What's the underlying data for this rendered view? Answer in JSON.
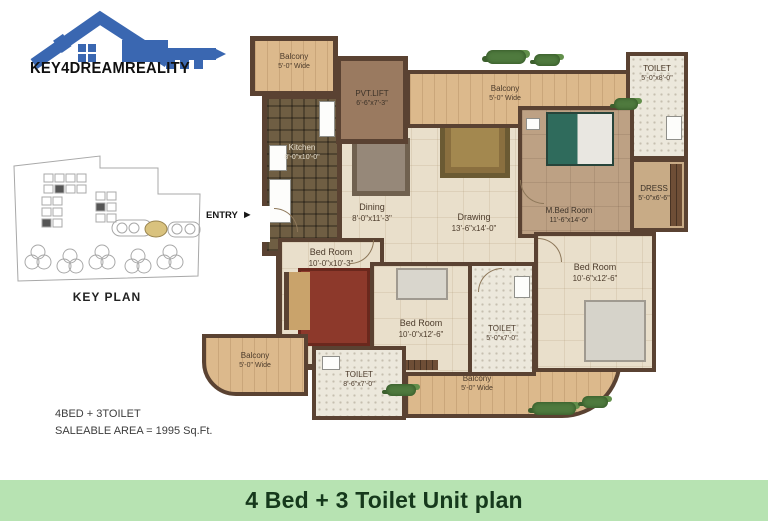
{
  "brand": {
    "name": "KEY4DREAMREALITY"
  },
  "key_plan": {
    "label": "KEY PLAN"
  },
  "entry": {
    "label": "ENTRY",
    "arrow_icon": "►"
  },
  "summary": {
    "line1": "4BED + 3TOILET",
    "line2": "SALEABLE  AREA = 1995 Sq.Ft."
  },
  "footer": {
    "title": "4 Bed + 3 Toilet Unit plan"
  },
  "colors": {
    "logo_blue": "#3a67b1",
    "wall_brown": "#5a4232",
    "balcony_tan": "#dcb98c",
    "floor_cream": "#e9dfcb",
    "footer_bg": "#b7e3b2",
    "footer_text": "#16391c",
    "keyplan_highlight": "#d9c27e"
  },
  "rooms": {
    "balcony_tl": {
      "name": "Balcony",
      "dims": "5'-0\" Wide"
    },
    "pvt_lift": {
      "name": "PVT.LIFT",
      "dims": "6'-6\"x7'-3\""
    },
    "balcony_tr": {
      "name": "Balcony",
      "dims": "5'-0\" Wide"
    },
    "toilet_top": {
      "name": "TOILET",
      "dims": "5'-0\"x8'-0\""
    },
    "kitchen": {
      "name": "Kitchen",
      "dims": "8'-0\"x10'-0\""
    },
    "dining": {
      "name": "Dining",
      "dims": "8'-0\"x11'-3\""
    },
    "drawing": {
      "name": "Drawing",
      "dims": "13'-6\"x14'-0\""
    },
    "master_bed": {
      "name": "M.Bed Room",
      "dims": "11'-6\"x14'-0\""
    },
    "dress": {
      "name": "DRESS",
      "dims": "5'-0\"x6'-6\""
    },
    "bed_left": {
      "name": "Bed Room",
      "dims": "10'-0\"x10'-3\""
    },
    "bed_mid": {
      "name": "Bed Room",
      "dims": "10'-0\"x12'-6\""
    },
    "toilet_mid": {
      "name": "TOILET",
      "dims": "5'-0\"x7'-0\""
    },
    "bed_right": {
      "name": "Bed Room",
      "dims": "10'-6\"x12'-6\""
    },
    "balcony_bl": {
      "name": "Balcony",
      "dims": "5'-0\" Wide"
    },
    "toilet_bottom": {
      "name": "TOILET",
      "dims": "8'-6\"x7'-0\""
    },
    "balcony_bottom": {
      "name": "Balcony",
      "dims": "5'-0\" Wide"
    }
  }
}
